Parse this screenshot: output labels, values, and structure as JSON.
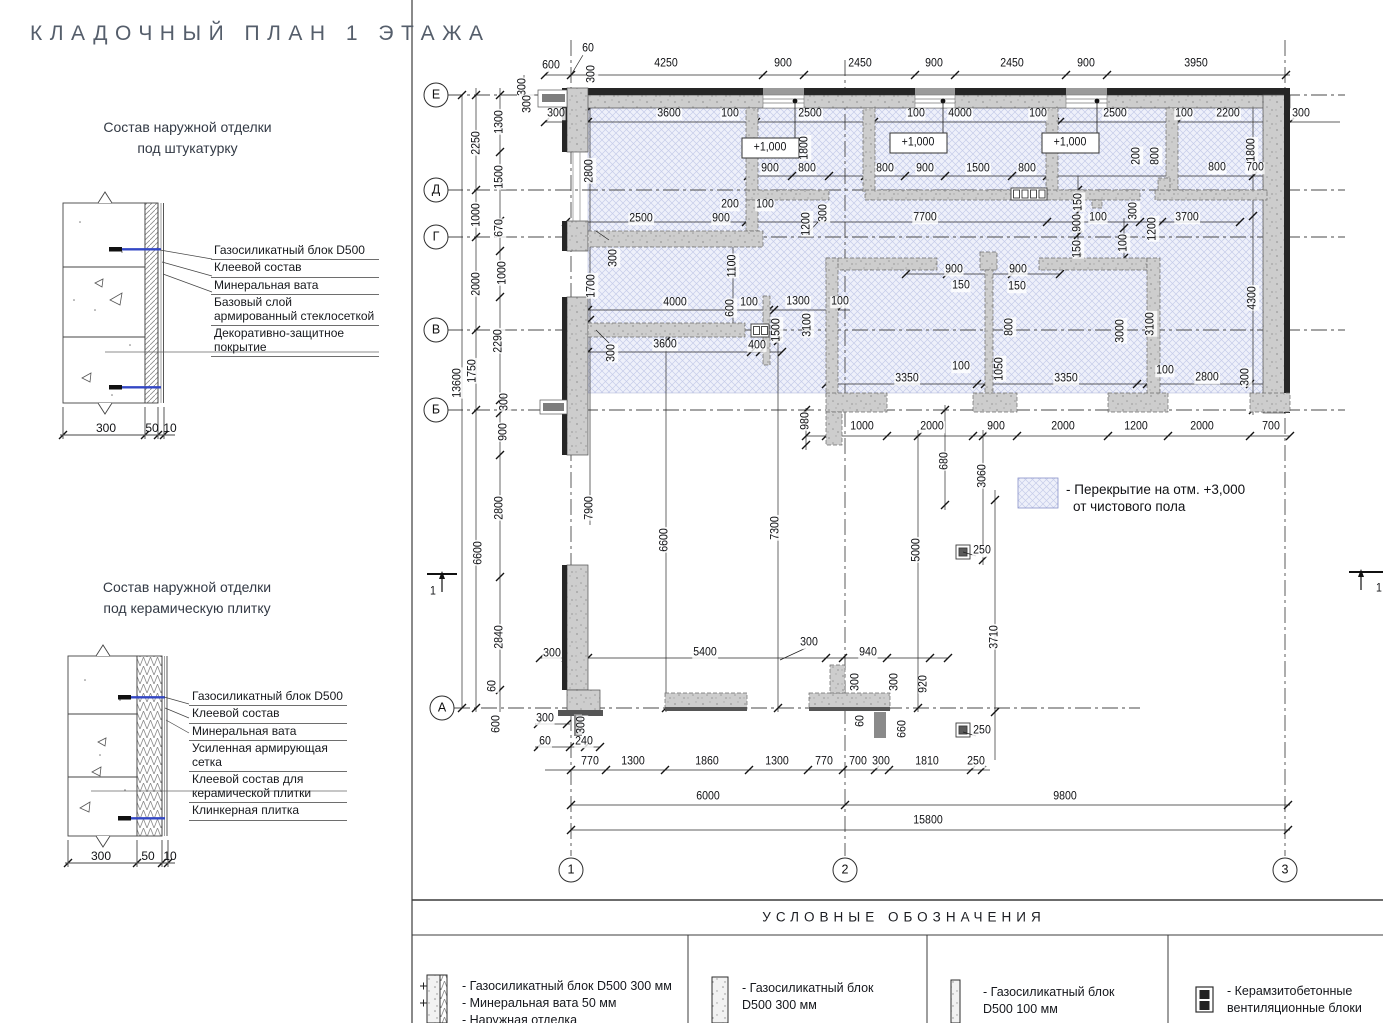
{
  "title": "КЛАДОЧНЫЙ ПЛАН 1 ЭТАЖА",
  "details": [
    {
      "title_line1": "Состав наружной отделки",
      "title_line2": "под штукатурку",
      "layers": [
        "Газосиликатный блок D500",
        "Клеевой состав",
        "Минеральная вата",
        "Базовый слой армированный стеклосеткой",
        "Декоративно-защитное покрытие"
      ],
      "dim1": "300",
      "dim2": "50",
      "dim3": "10"
    },
    {
      "title_line1": "Состав наружной отделки",
      "title_line2": "под керамическую плитку",
      "layers": [
        "Газосиликатный блок D500",
        "Клеевой состав",
        "Минеральная вата",
        "Усиленная армирующая сетка",
        "Клеевой состав для керамической плитки",
        "Клинкерная плитка"
      ],
      "dim1": "300",
      "dim2": "50",
      "dim3": "10"
    }
  ],
  "plan": {
    "axes_rows": [
      {
        "label": "Е",
        "x": 436,
        "y": 95
      },
      {
        "label": "Д",
        "x": 436,
        "y": 190
      },
      {
        "label": "Г",
        "x": 436,
        "y": 237
      },
      {
        "label": "В",
        "x": 436,
        "y": 330
      },
      {
        "label": "Б",
        "x": 436,
        "y": 410
      },
      {
        "label": "А",
        "x": 442,
        "y": 708
      }
    ],
    "axes_cols": [
      {
        "label": "1",
        "x": 571,
        "y": 870
      },
      {
        "label": "2",
        "x": 845,
        "y": 870
      },
      {
        "label": "3",
        "x": 1285,
        "y": 870
      }
    ],
    "note_line1": "- Перекрытие на отм. +3,000",
    "note_line2": "от чистового пола",
    "labels": [
      {
        "t": "600",
        "x": 551,
        "y": 66
      },
      {
        "t": "60",
        "x": 588,
        "y": 49
      },
      {
        "t": "4250",
        "x": 666,
        "y": 64
      },
      {
        "t": "900",
        "x": 783,
        "y": 64
      },
      {
        "t": "2450",
        "x": 860,
        "y": 64
      },
      {
        "t": "900",
        "x": 934,
        "y": 64
      },
      {
        "t": "2450",
        "x": 1012,
        "y": 64
      },
      {
        "t": "900",
        "x": 1086,
        "y": 64
      },
      {
        "t": "3950",
        "x": 1196,
        "y": 64
      },
      {
        "t": "300",
        "x": 556,
        "y": 114
      },
      {
        "t": "3600",
        "x": 669,
        "y": 114
      },
      {
        "t": "100",
        "x": 730,
        "y": 114
      },
      {
        "t": "2500",
        "x": 810,
        "y": 114
      },
      {
        "t": "100",
        "x": 916,
        "y": 114
      },
      {
        "t": "4000",
        "x": 960,
        "y": 114
      },
      {
        "t": "100",
        "x": 1038,
        "y": 114
      },
      {
        "t": "2500",
        "x": 1115,
        "y": 114
      },
      {
        "t": "100",
        "x": 1184,
        "y": 114
      },
      {
        "t": "2200",
        "x": 1228,
        "y": 114
      },
      {
        "t": "300",
        "x": 1301,
        "y": 114
      },
      {
        "t": "300",
        "x": 523,
        "y": 87,
        "r": 1
      },
      {
        "t": "300",
        "x": 528,
        "y": 104,
        "r": 1
      },
      {
        "t": "300",
        "x": 592,
        "y": 74,
        "r": 1
      },
      {
        "t": "1300",
        "x": 500,
        "y": 122,
        "r": 1
      },
      {
        "t": "1500",
        "x": 500,
        "y": 177,
        "r": 1
      },
      {
        "t": "670",
        "x": 500,
        "y": 228,
        "r": 1
      },
      {
        "t": "1000",
        "x": 503,
        "y": 273,
        "r": 1
      },
      {
        "t": "2290",
        "x": 499,
        "y": 341,
        "r": 1
      },
      {
        "t": "300",
        "x": 505,
        "y": 402,
        "r": 1
      },
      {
        "t": "900",
        "x": 504,
        "y": 432,
        "r": 1
      },
      {
        "t": "2800",
        "x": 500,
        "y": 508,
        "r": 1
      },
      {
        "t": "2840",
        "x": 500,
        "y": 637,
        "r": 1
      },
      {
        "t": "60",
        "x": 493,
        "y": 686,
        "r": 1
      },
      {
        "t": "600",
        "x": 497,
        "y": 724,
        "r": 1
      },
      {
        "t": "2250",
        "x": 477,
        "y": 143,
        "r": 1
      },
      {
        "t": "1000",
        "x": 477,
        "y": 215,
        "r": 1
      },
      {
        "t": "2000",
        "x": 477,
        "y": 284,
        "r": 1
      },
      {
        "t": "1750",
        "x": 473,
        "y": 371,
        "r": 1
      },
      {
        "t": "6600",
        "x": 479,
        "y": 553,
        "r": 1
      },
      {
        "t": "13600",
        "x": 458,
        "y": 383,
        "r": 1
      },
      {
        "t": "+1,000",
        "x": 770,
        "y": 148
      },
      {
        "t": "+1,000",
        "x": 918,
        "y": 143
      },
      {
        "t": "+1,000",
        "x": 1070,
        "y": 143
      },
      {
        "t": "1800",
        "x": 805,
        "y": 148,
        "r": 1
      },
      {
        "t": "1800",
        "x": 1252,
        "y": 150,
        "r": 1
      },
      {
        "t": "900",
        "x": 770,
        "y": 169
      },
      {
        "t": "800",
        "x": 807,
        "y": 169
      },
      {
        "t": "800",
        "x": 885,
        "y": 169
      },
      {
        "t": "900",
        "x": 925,
        "y": 169
      },
      {
        "t": "1500",
        "x": 978,
        "y": 169
      },
      {
        "t": "800",
        "x": 1027,
        "y": 169
      },
      {
        "t": "800",
        "x": 1217,
        "y": 168
      },
      {
        "t": "700",
        "x": 1255,
        "y": 168
      },
      {
        "t": "200",
        "x": 1137,
        "y": 156,
        "r": 1
      },
      {
        "t": "800",
        "x": 1156,
        "y": 156,
        "r": 1
      },
      {
        "t": "200",
        "x": 730,
        "y": 205
      },
      {
        "t": "100",
        "x": 765,
        "y": 205
      },
      {
        "t": "2500",
        "x": 641,
        "y": 219
      },
      {
        "t": "900",
        "x": 721,
        "y": 219
      },
      {
        "t": "7700",
        "x": 925,
        "y": 218
      },
      {
        "t": "100",
        "x": 1098,
        "y": 218
      },
      {
        "t": "3700",
        "x": 1187,
        "y": 218
      },
      {
        "t": "2800",
        "x": 590,
        "y": 171,
        "r": 1
      },
      {
        "t": "300",
        "x": 614,
        "y": 258,
        "r": 1
      },
      {
        "t": "1700",
        "x": 592,
        "y": 286,
        "r": 1
      },
      {
        "t": "1100",
        "x": 733,
        "y": 266,
        "r": 1
      },
      {
        "t": "1200",
        "x": 807,
        "y": 224,
        "r": 1
      },
      {
        "t": "300",
        "x": 824,
        "y": 213,
        "r": 1
      },
      {
        "t": "150",
        "x": 1079,
        "y": 202,
        "r": 1
      },
      {
        "t": "900",
        "x": 1078,
        "y": 223,
        "r": 1
      },
      {
        "t": "150",
        "x": 1078,
        "y": 249,
        "r": 1
      },
      {
        "t": "100",
        "x": 1124,
        "y": 243,
        "r": 1
      },
      {
        "t": "300",
        "x": 1134,
        "y": 211,
        "r": 1
      },
      {
        "t": "1200",
        "x": 1153,
        "y": 229,
        "r": 1
      },
      {
        "t": "900",
        "x": 954,
        "y": 270
      },
      {
        "t": "900",
        "x": 1018,
        "y": 270
      },
      {
        "t": "150",
        "x": 961,
        "y": 286
      },
      {
        "t": "150",
        "x": 1017,
        "y": 287
      },
      {
        "t": "4000",
        "x": 675,
        "y": 303
      },
      {
        "t": "100",
        "x": 749,
        "y": 303
      },
      {
        "t": "1300",
        "x": 798,
        "y": 302
      },
      {
        "t": "100",
        "x": 840,
        "y": 302
      },
      {
        "t": "600",
        "x": 731,
        "y": 308,
        "r": 1
      },
      {
        "t": "1500",
        "x": 777,
        "y": 330,
        "r": 1
      },
      {
        "t": "3100",
        "x": 808,
        "y": 325,
        "r": 1
      },
      {
        "t": "800",
        "x": 1010,
        "y": 327,
        "r": 1
      },
      {
        "t": "3000",
        "x": 1121,
        "y": 331,
        "r": 1
      },
      {
        "t": "3100",
        "x": 1151,
        "y": 324,
        "r": 1
      },
      {
        "t": "4300",
        "x": 1253,
        "y": 298,
        "r": 1
      },
      {
        "t": "3600",
        "x": 665,
        "y": 345
      },
      {
        "t": "400",
        "x": 757,
        "y": 346
      },
      {
        "t": "300",
        "x": 612,
        "y": 353,
        "r": 1
      },
      {
        "t": "100",
        "x": 961,
        "y": 367
      },
      {
        "t": "1050",
        "x": 1000,
        "y": 369,
        "r": 1
      },
      {
        "t": "3350",
        "x": 907,
        "y": 379
      },
      {
        "t": "3350",
        "x": 1066,
        "y": 379
      },
      {
        "t": "100",
        "x": 1165,
        "y": 371
      },
      {
        "t": "2800",
        "x": 1207,
        "y": 378
      },
      {
        "t": "300",
        "x": 1246,
        "y": 377,
        "r": 1
      },
      {
        "t": "980",
        "x": 806,
        "y": 421,
        "r": 1
      },
      {
        "t": "1000",
        "x": 862,
        "y": 427
      },
      {
        "t": "2000",
        "x": 932,
        "y": 427
      },
      {
        "t": "900",
        "x": 996,
        "y": 427
      },
      {
        "t": "2000",
        "x": 1063,
        "y": 427
      },
      {
        "t": "1200",
        "x": 1136,
        "y": 427
      },
      {
        "t": "2000",
        "x": 1202,
        "y": 427
      },
      {
        "t": "700",
        "x": 1271,
        "y": 427
      },
      {
        "t": "680",
        "x": 945,
        "y": 461,
        "r": 1
      },
      {
        "t": "3060",
        "x": 983,
        "y": 476,
        "r": 1
      },
      {
        "t": "5000",
        "x": 917,
        "y": 550,
        "r": 1
      },
      {
        "t": "3710",
        "x": 995,
        "y": 637,
        "r": 1
      },
      {
        "t": "250",
        "x": 982,
        "y": 551
      },
      {
        "t": "250",
        "x": 982,
        "y": 731
      },
      {
        "t": "7900",
        "x": 590,
        "y": 508,
        "r": 1
      },
      {
        "t": "6600",
        "x": 665,
        "y": 540,
        "r": 1
      },
      {
        "t": "7300",
        "x": 776,
        "y": 528,
        "r": 1
      },
      {
        "t": "300",
        "x": 552,
        "y": 654
      },
      {
        "t": "5400",
        "x": 705,
        "y": 653
      },
      {
        "t": "300",
        "x": 809,
        "y": 643
      },
      {
        "t": "940",
        "x": 868,
        "y": 653
      },
      {
        "t": "920",
        "x": 924,
        "y": 684,
        "r": 1
      },
      {
        "t": "300",
        "x": 856,
        "y": 682,
        "r": 1
      },
      {
        "t": "300",
        "x": 895,
        "y": 682,
        "r": 1
      },
      {
        "t": "60",
        "x": 861,
        "y": 721,
        "r": 1
      },
      {
        "t": "660",
        "x": 903,
        "y": 729,
        "r": 1
      },
      {
        "t": "300",
        "x": 545,
        "y": 719
      },
      {
        "t": "300",
        "x": 582,
        "y": 725,
        "r": 1
      },
      {
        "t": "60",
        "x": 545,
        "y": 742
      },
      {
        "t": "240",
        "x": 584,
        "y": 742
      },
      {
        "t": "770",
        "x": 590,
        "y": 762
      },
      {
        "t": "1300",
        "x": 633,
        "y": 762
      },
      {
        "t": "1860",
        "x": 707,
        "y": 762
      },
      {
        "t": "1300",
        "x": 777,
        "y": 762
      },
      {
        "t": "770",
        "x": 824,
        "y": 762
      },
      {
        "t": "700",
        "x": 858,
        "y": 762
      },
      {
        "t": "300",
        "x": 881,
        "y": 762
      },
      {
        "t": "1810",
        "x": 927,
        "y": 762
      },
      {
        "t": "250",
        "x": 976,
        "y": 762
      },
      {
        "t": "6000",
        "x": 708,
        "y": 797
      },
      {
        "t": "9800",
        "x": 1065,
        "y": 797
      },
      {
        "t": "15800",
        "x": 928,
        "y": 821
      },
      {
        "t": "1",
        "x": 433,
        "y": 592
      },
      {
        "t": "1",
        "x": 1379,
        "y": 589
      }
    ]
  },
  "legend": {
    "header": "УСЛОВНЫЕ ОБОЗНАЧЕНИЯ",
    "items": [
      {
        "icon": "masonry-insulated-wall-icon",
        "lines": [
          "- Газосиликатный блок D500 300 мм",
          "- Минеральная вата 50 мм",
          "- Наружная отделка"
        ]
      },
      {
        "icon": "masonry-block-300-icon",
        "lines": [
          "- Газосиликатный блок",
          "  D500 300 мм"
        ]
      },
      {
        "icon": "masonry-block-100-icon",
        "lines": [
          "- Газосиликатный блок",
          "  D500 100 мм"
        ]
      },
      {
        "icon": "vent-block-icon",
        "lines": [
          "- Керамзитобетонные",
          "  вентиляционные блоки"
        ]
      }
    ]
  },
  "colors": {
    "title": "#555e6b",
    "hatch_bg": "#eef0fa",
    "hatch_line": "#bfc6e6",
    "wall_fill": "#cdcdcd",
    "wall_dark": "#262626",
    "anchor_blue": "#3347c4",
    "line": "#1c1c1c"
  }
}
